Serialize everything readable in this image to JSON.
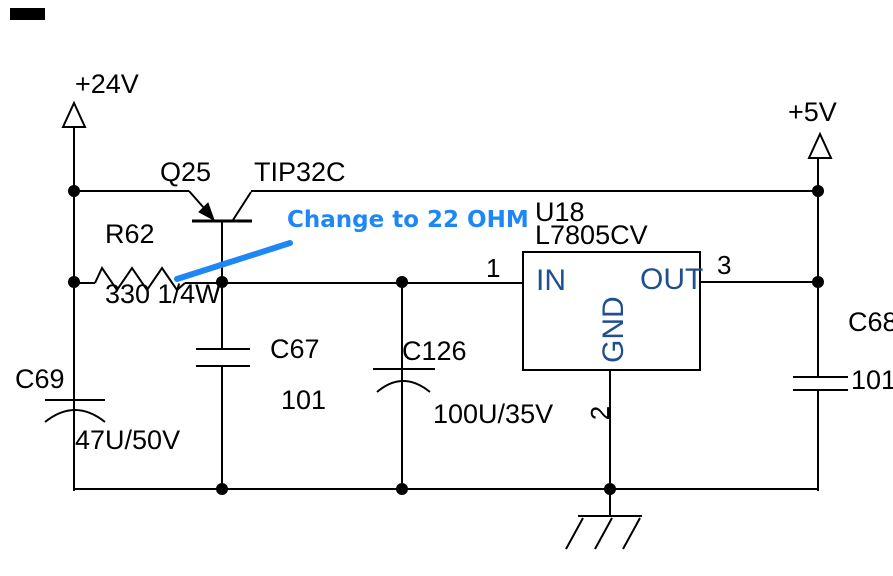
{
  "diagram": {
    "type": "circuit-schematic",
    "description_visible_only": "voltage regulator schematic",
    "colors": {
      "background": "#ffffff",
      "wire": "#000000",
      "label_text": "#000000",
      "ic_text": "#1f4e91",
      "annotation": "#1e86f5"
    },
    "power": {
      "rail_in": "+24V",
      "rail_out": "+5V"
    },
    "transistor": {
      "ref": "Q25",
      "part": "TIP32C"
    },
    "resistor": {
      "ref": "R62",
      "value": "330 1/4W"
    },
    "regulator": {
      "ref": "U18",
      "part": "L7805CV",
      "pin_in_label": "IN",
      "pin_out_label": "OUT",
      "pin_gnd_label": "GND",
      "pin1_number": "1",
      "pin2_number": "2",
      "pin3_number": "3"
    },
    "capacitors": {
      "c69": {
        "ref": "C69",
        "value": "47U/50V"
      },
      "c67": {
        "ref": "C67",
        "value": "101"
      },
      "c126": {
        "ref": "C126",
        "value": "100U/35V"
      },
      "c68": {
        "ref": "C68",
        "value": "101"
      }
    },
    "annotation": {
      "text": "Change to 22 OHM"
    }
  }
}
